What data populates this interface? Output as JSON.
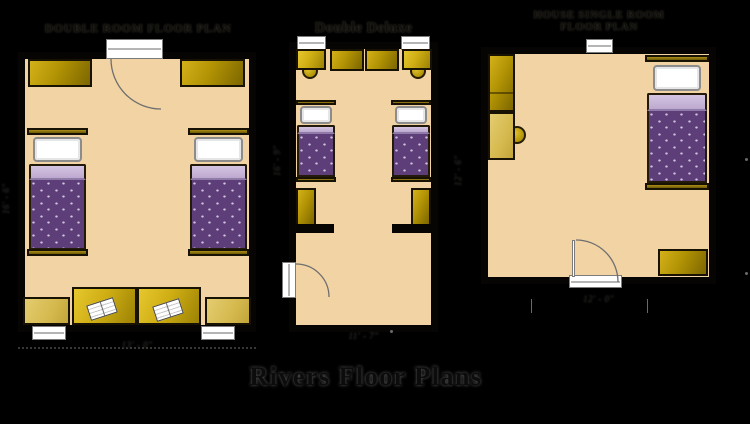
{
  "page": {
    "background_color": "#000000",
    "main_title": "Rivers Floor Plans"
  },
  "colors": {
    "floor": "#f2d3a4",
    "wall": "#070503",
    "wardrobe_dark_yellow": "#b29304",
    "desk_bright_yellow": "#cfae14",
    "dresser_light_yellow": "#d5b94e",
    "blanket_purple": "#5d3e79",
    "blanket_fold_lavender": "#c4b1d4",
    "pillow_white": "#ffffff",
    "title_text": "#12100c"
  },
  "symbols": {
    "door_swing_icon": "quarter-circle arc",
    "window_icon": "white rectangle with center line",
    "bed_icon": "pillow + purple dotted blanket",
    "book_icon": "open white book"
  },
  "plans": {
    "double": {
      "title": "DOUBLE ROOM FLOOR PLAN",
      "width_label": "13' - 0\"",
      "height_label": "16' - 6\""
    },
    "deluxe": {
      "title": "Double Deluxe",
      "width_label": "11' - 7\"",
      "height_label": "16' - 9\""
    },
    "single": {
      "title_line1": "HOUSE SINGLE ROOM",
      "title_line2": "FLOOR PLAN",
      "width_label": "12' - 0\"",
      "height_label": "12' - 6\""
    }
  }
}
